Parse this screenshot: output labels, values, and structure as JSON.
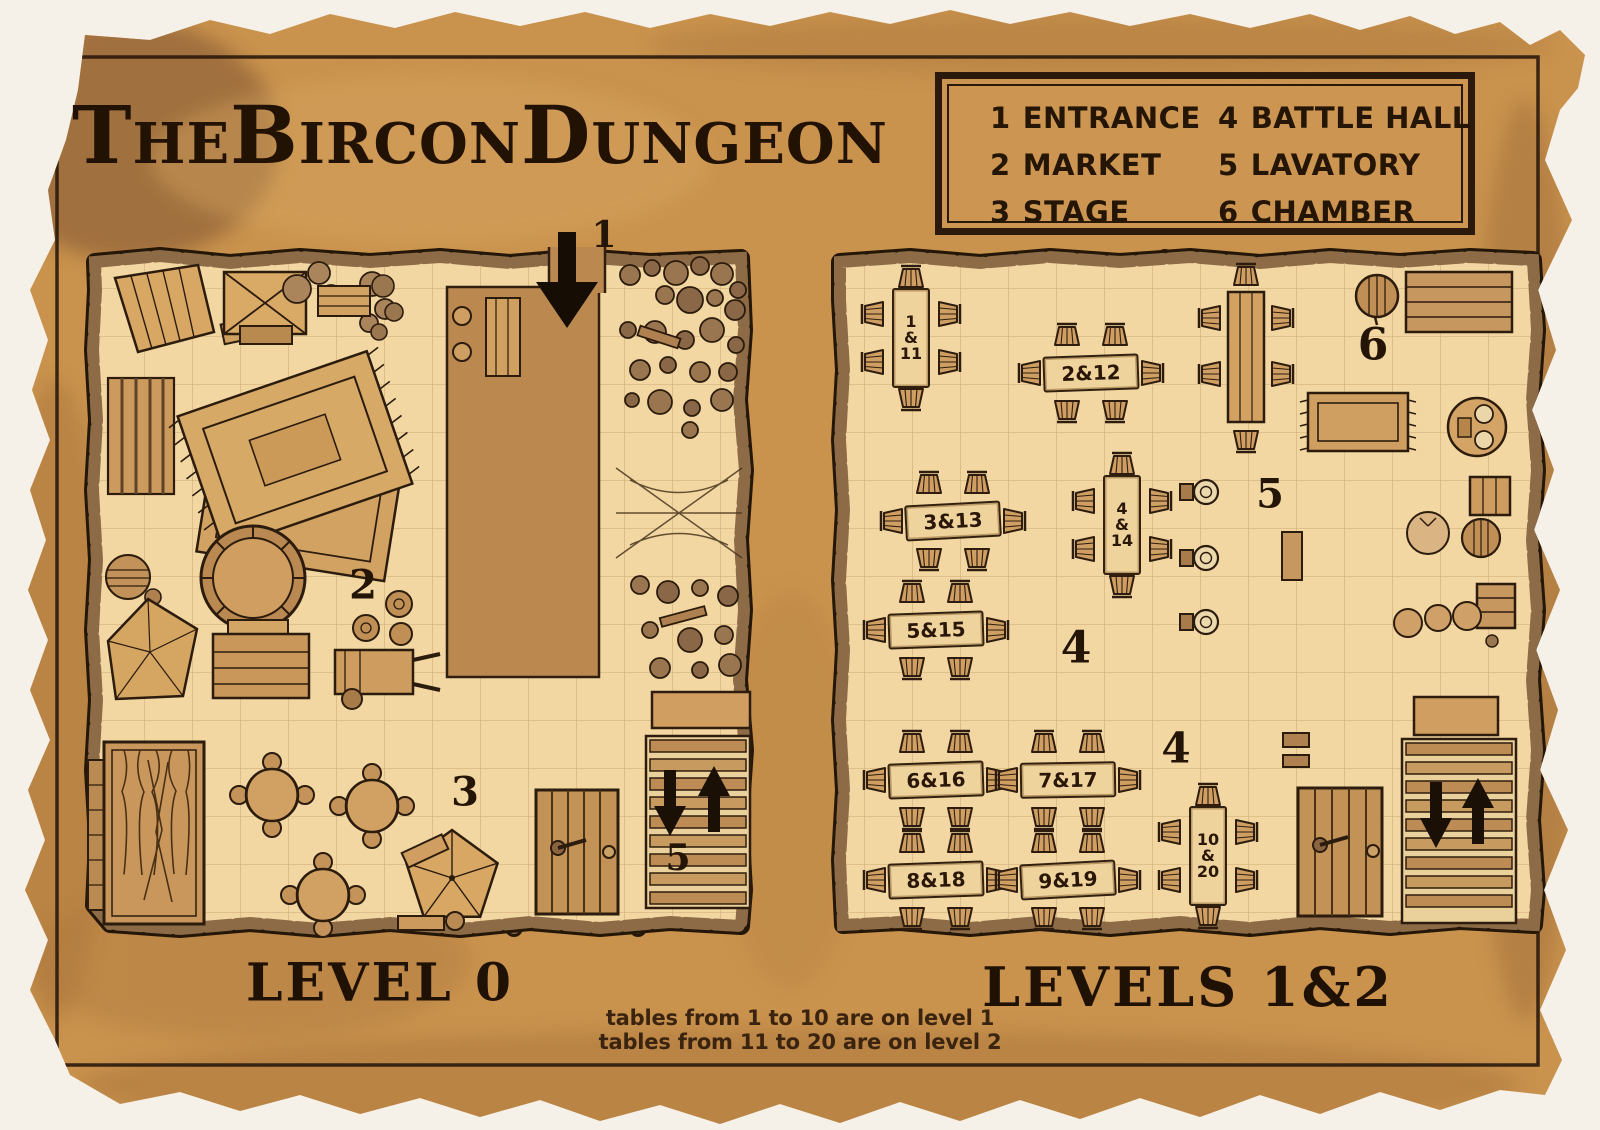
{
  "title": "TheBirconDungeon",
  "legend": {
    "items": [
      {
        "number": "1",
        "label": "ENTRANCE"
      },
      {
        "number": "2",
        "label": "MARKET"
      },
      {
        "number": "3",
        "label": "STAGE"
      },
      {
        "number": "4",
        "label": "BATTLE HALL"
      },
      {
        "number": "5",
        "label": "LAVATORY"
      },
      {
        "number": "6",
        "label": "CHAMBER"
      }
    ]
  },
  "level0": {
    "label": "LEVEL 0",
    "markers": {
      "entrance": "1",
      "market": "2",
      "stage": "3",
      "stairs": "5"
    }
  },
  "levels12": {
    "label": "LEVELS 1&2",
    "markers": {
      "hall_upper": "4",
      "hall_lower": "4",
      "lavatory": "5",
      "chamber": "6"
    },
    "tables": {
      "t1": "1\n&\n11",
      "t2": "2&12",
      "t3": "3&13",
      "t4": "4\n&\n14",
      "t5": "5&15",
      "t6": "6&16",
      "t7": "7&17",
      "t8": "8&18",
      "t9": "9&19",
      "t10": "10\n&\n20"
    }
  },
  "notes": {
    "line1": "tables from 1 to 10 are on level 1",
    "line2": "tables from 11 to 20 are on level 2"
  },
  "colors": {
    "parchment": "#c9924d",
    "floor": "#f2d7a2",
    "wall": "#8d6b47",
    "ink": "#2b1a0c"
  }
}
